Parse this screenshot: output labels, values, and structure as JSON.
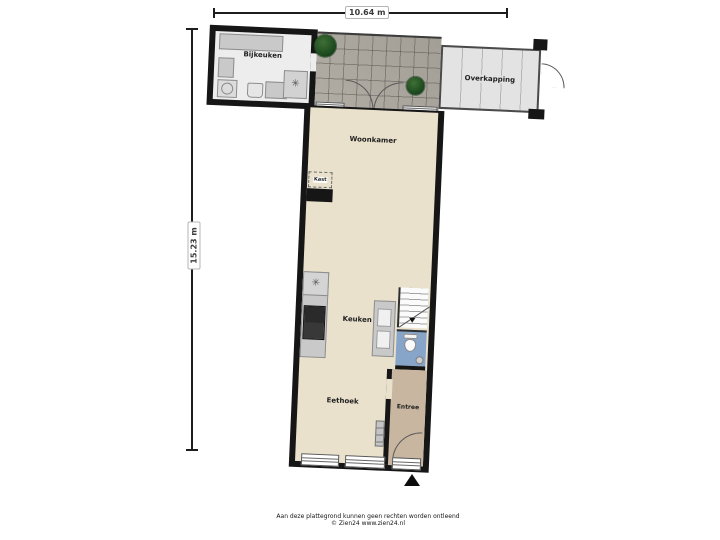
{
  "dimensions": {
    "width": "10.64 m",
    "height": "15.23 m"
  },
  "rooms": {
    "bijkeuken": "Bijkeuken",
    "overkapping": "Overkapping",
    "woonkamer": "Woonkamer",
    "kast": "Kast",
    "keuken": "Keuken",
    "eethoek": "Eethoek",
    "entree": "Entree"
  },
  "icons": {
    "star": "✳"
  },
  "footer": {
    "line1": "Aan deze plattegrond kunnen geen rechten worden ontleend",
    "line2": "© Zien24 www.zien24.nl"
  },
  "colors": {
    "wall": "#161616",
    "floor_living": "#e9e1cc",
    "floor_entree": "#c8b6a1",
    "floor_toilet": "#87a5c9",
    "patio_tiles": "#aba79e",
    "overkapping": "#e3e3e3",
    "tree_green": "#2d5a28"
  }
}
